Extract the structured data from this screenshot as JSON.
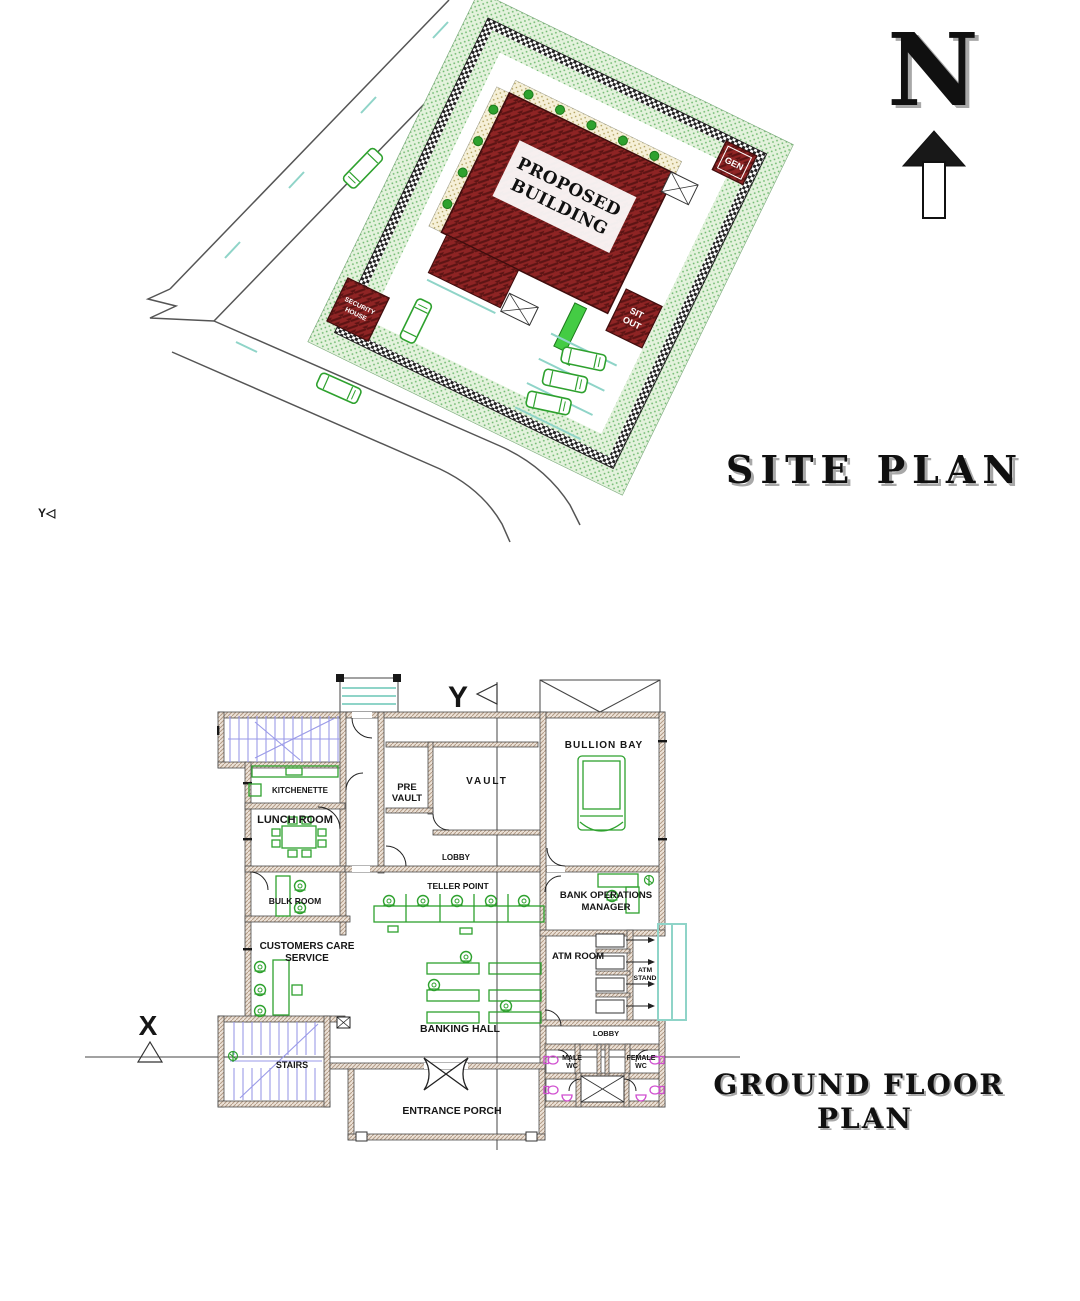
{
  "titles": {
    "site": "SITE PLAN",
    "floor_l1": "GROUND FLOOR",
    "floor_l2": "PLAN"
  },
  "north": {
    "letter": "N"
  },
  "site": {
    "building_l1": "PROPOSED",
    "building_l2": "BUILDING",
    "gen": "GEN",
    "sit_out_l1": "SIT",
    "sit_out_l2": "OUT",
    "security_l1": "SECURITY",
    "security_l2": "HOUSE",
    "left_marker": "Y◁"
  },
  "floor": {
    "marker_x": "X",
    "marker_y": "Y",
    "rooms": {
      "bullion_bay": "BULLION BAY",
      "pre_vault_l1": "PRE",
      "pre_vault_l2": "VAULT",
      "vault": "VAULT",
      "kitchenette": "KITCHENETTE",
      "lunch_room": "LUNCH ROOM",
      "lobby_upper": "LOBBY",
      "teller_point": "TELLER POINT",
      "bulk_room": "BULK ROOM",
      "bank_ops_l1": "BANK OPERATIONS",
      "bank_ops_l2": "MANAGER",
      "ccs_l1": "CUSTOMERS CARE",
      "ccs_l2": "SERVICE",
      "atm_room": "ATM ROOM",
      "atm_stand_l1": "ATM",
      "atm_stand_l2": "STAND",
      "banking_hall": "BANKING HALL",
      "lobby_lower": "LOBBY",
      "stairs": "STAIRS",
      "male_wc_l1": "MALE",
      "male_wc_l2": "WC",
      "female_wc_l1": "FEMALE",
      "female_wc_l2": "WC",
      "entrance_porch": "ENTRANCE PORCH"
    }
  },
  "colors": {
    "building_red": "#8e2424",
    "hatch_dark": "#5c1414",
    "wall_tan": "#b39b86",
    "wall_bg": "#ece2d8",
    "furniture_green": "#2ea12e",
    "bright_green": "#44cc44",
    "stairs_purple": "#9a9ae8",
    "wc_magenta": "#d04fd0",
    "teal": "#8fd4c8",
    "landscape_green": "#e3f2dc",
    "landscape_dot": "#6cb86c",
    "cream": "#f6f0d8",
    "cream_dot": "#a89850"
  }
}
